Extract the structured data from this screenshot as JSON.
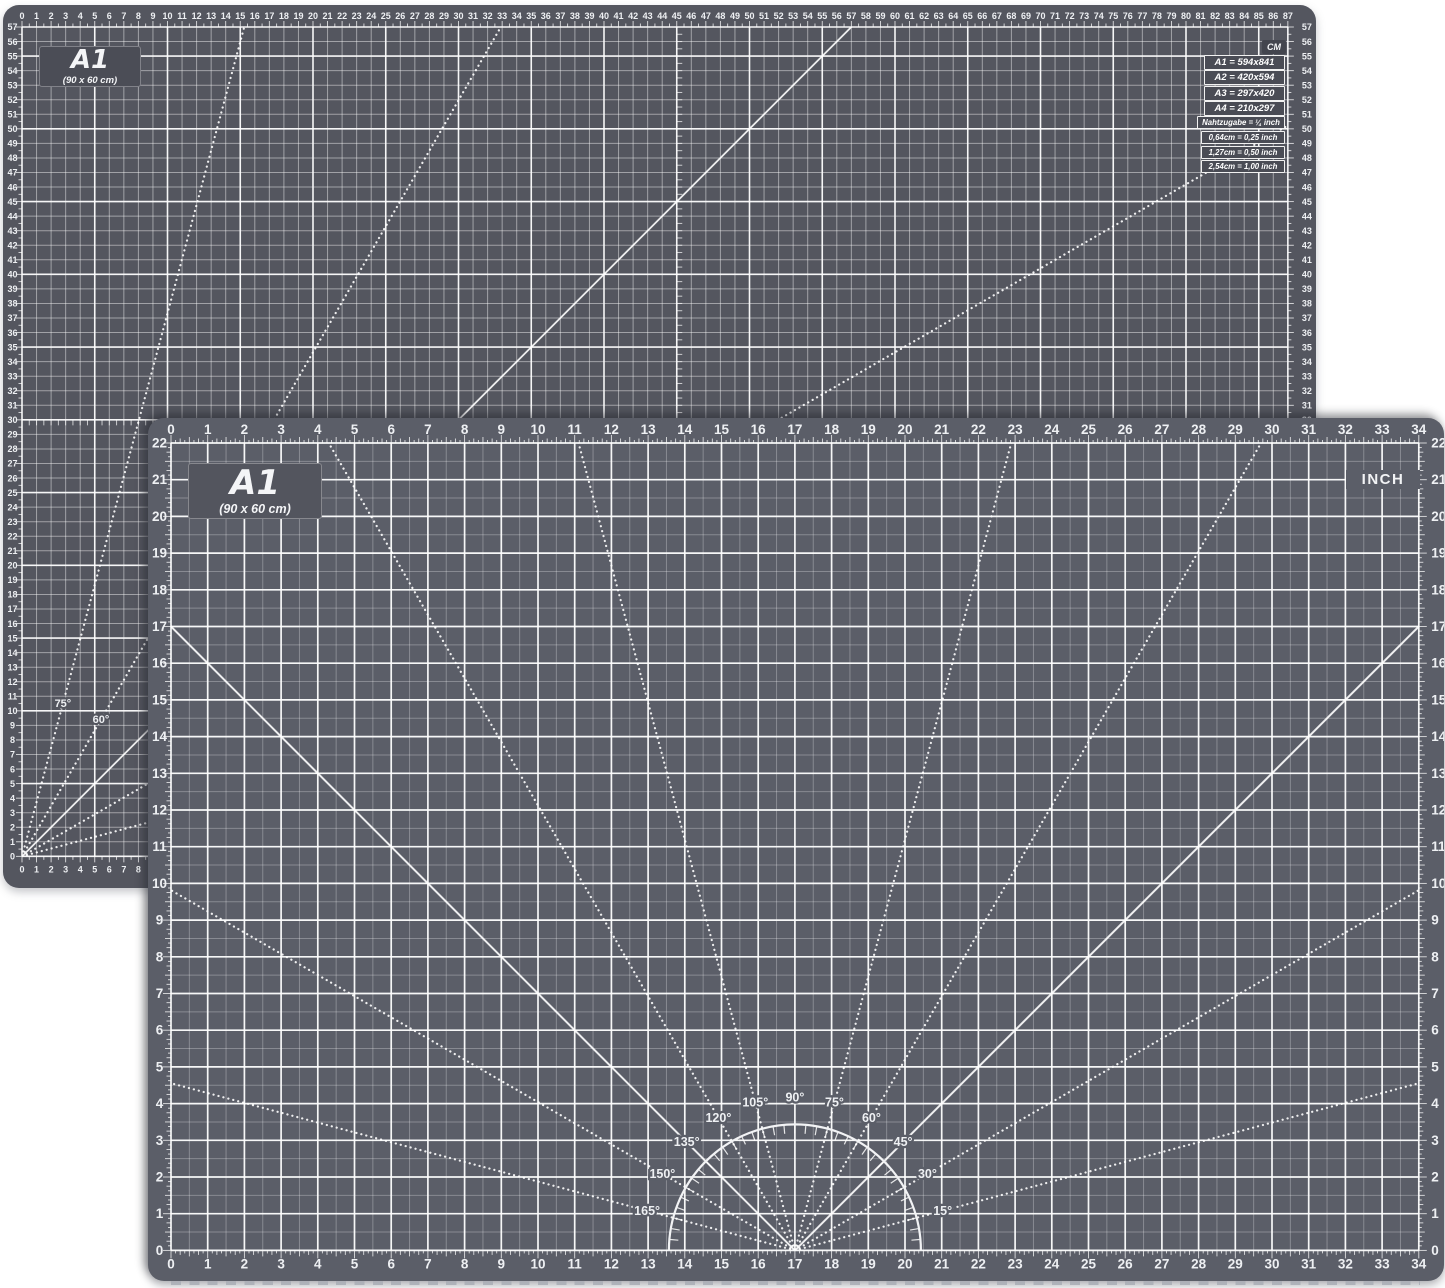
{
  "colors": {
    "background": "#ffffff",
    "back_mat_bg": "#54565f",
    "front_mat_bg": "#5b5e68",
    "badge_bg": "#4b4d56",
    "grid_major": "rgba(255,255,255,0.95)",
    "grid_minor_cm": "rgba(255,255,255,0.45)",
    "grid_half_inch": "rgba(255,255,255,0.28)",
    "tick": "rgba(255,255,255,0.8)",
    "ray": "rgba(255,255,255,0.9)",
    "number_text": "#eef0f3"
  },
  "back_mat": {
    "name_label": "A1",
    "size_label": "(90 x 60 cm)",
    "unit_label": "CM",
    "ruler": {
      "h_from": 0,
      "h_to": 87,
      "v_from": 0,
      "v_to": 57,
      "unit": "cm",
      "major_every": 5
    },
    "center_lines": {
      "vertical_cm": 45,
      "horizontal_cm": 30
    },
    "size_table": [
      "A1 = 594x841",
      "A2 = 420x594",
      "A3 = 297x420",
      "A4 = 210x297"
    ],
    "seam_row": "Nahtzugabe = ¼ inch",
    "conversion_table": [
      "0,64cm = 0,25 inch",
      "1,27cm = 0,50 inch",
      "2,54cm = 1,00 inch"
    ],
    "angle_lines": [
      {
        "deg": 15,
        "style": "dotted",
        "label": ""
      },
      {
        "deg": 30,
        "style": "dotted",
        "label": ""
      },
      {
        "deg": 45,
        "style": "solid",
        "label": ""
      },
      {
        "deg": 60,
        "style": "dotted",
        "label": "60°"
      },
      {
        "deg": 75,
        "style": "dotted",
        "label": "75°"
      }
    ]
  },
  "front_mat": {
    "name_label": "A1",
    "size_label": "(90 x 60 cm)",
    "unit_label": "INCH",
    "ruler": {
      "h_from": 0,
      "h_to": 34,
      "v_from": 0,
      "v_to": 22,
      "unit": "inch",
      "center_inch": 17
    },
    "protractor": {
      "angles": [
        15,
        30,
        45,
        60,
        75,
        90,
        105,
        120,
        135,
        150,
        165
      ],
      "solid_angles": [
        45,
        90,
        135
      ],
      "labels": [
        "15°",
        "30°",
        "45°",
        "60°",
        "75°",
        "90°",
        "105°",
        "120°",
        "135°",
        "150°",
        "165°"
      ]
    }
  }
}
